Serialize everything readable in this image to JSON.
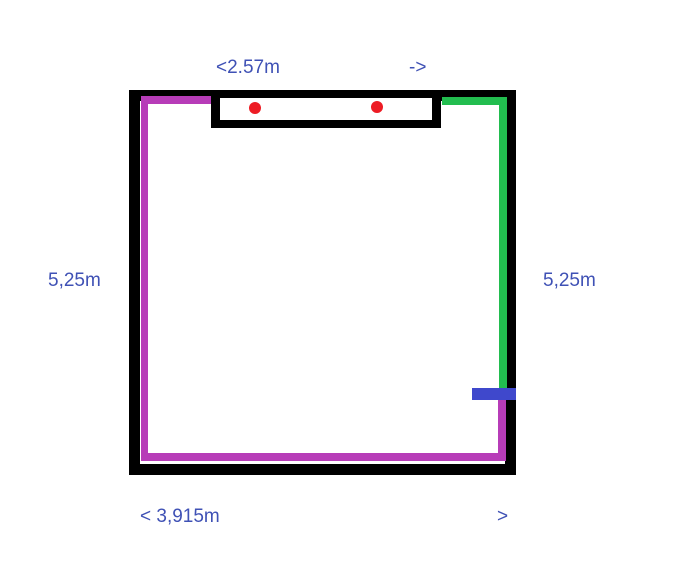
{
  "labels": {
    "window_width": "<2.57m",
    "window_arrow": "->",
    "left_height": "5,25m",
    "right_height": "5,25m",
    "bottom_width": "< 3,915m",
    "bottom_arrow": ">"
  },
  "colors": {
    "background": "#ffffff",
    "wall": "#000000",
    "magenta_line": "#b73cb8",
    "green_line": "#22bd4f",
    "blue_marker": "#3f48cc",
    "red_dot": "#ed1c24",
    "label_text": "#3f51b5"
  }
}
